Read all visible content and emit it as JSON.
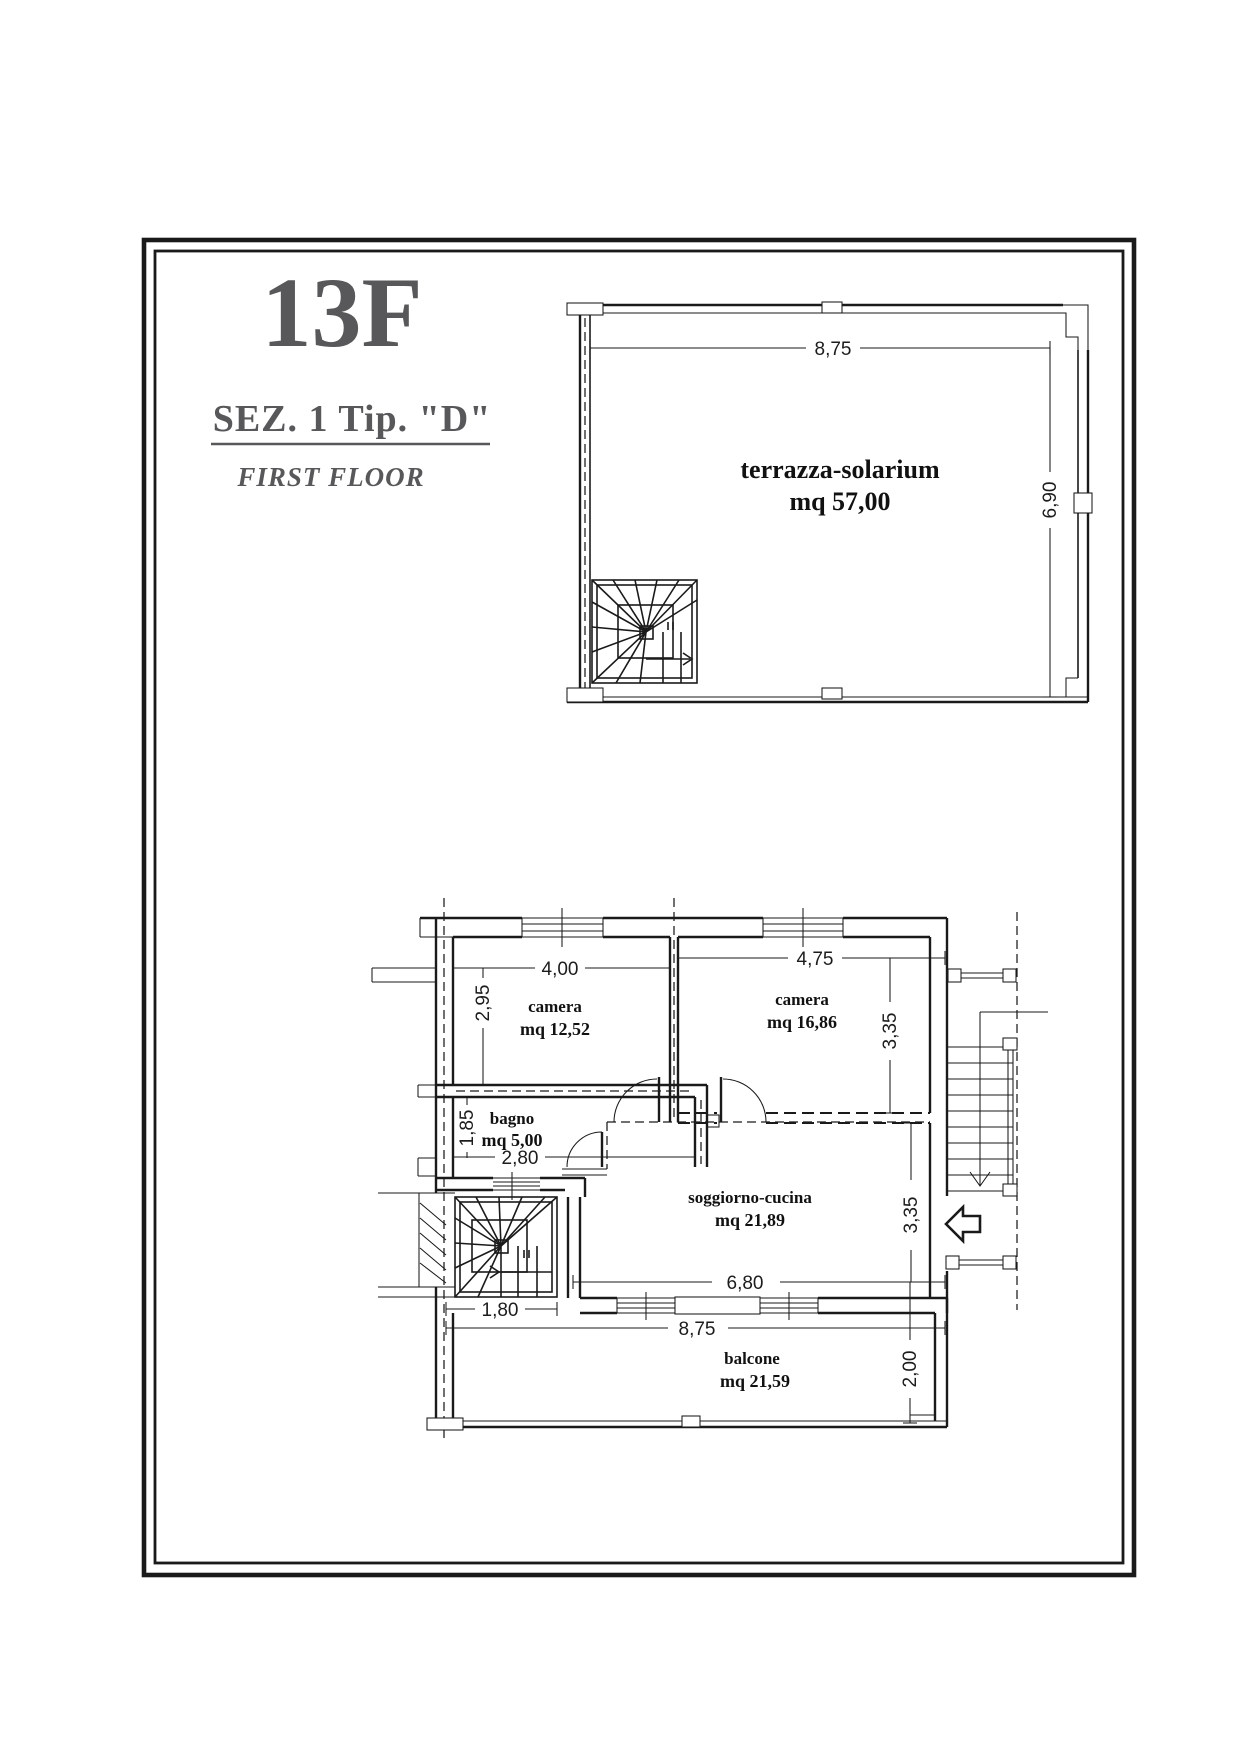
{
  "title_block": {
    "unit": "13F",
    "section": "SEZ. 1  Tip. \"D\"",
    "floor": "FIRST FLOOR"
  },
  "terrace": {
    "room": "terrazza-solarium",
    "area": "mq 57,00",
    "dim_width": "8,75",
    "dim_depth": "6,90"
  },
  "apartment": {
    "camera1": {
      "name": "camera",
      "area": "mq 12,52",
      "dim_width": "4,00",
      "dim_depth": "2,95"
    },
    "camera2": {
      "name": "camera",
      "area": "mq 16,86",
      "dim_width": "4,75",
      "dim_depth": "3,35"
    },
    "bagno": {
      "name": "bagno",
      "area": "mq 5,00",
      "dim_width": "2,80",
      "dim_depth": "1,85"
    },
    "soggiorno": {
      "name": "soggiorno-cucina",
      "area": "mq 21,89",
      "dim_width": "6,80",
      "dim_depth": "3,35"
    },
    "balcone": {
      "name": "balcone",
      "area": "mq 21,59",
      "dim_width": "8,75",
      "dim_depth": "2,00"
    },
    "stair": {
      "dim_width": "1,80"
    }
  },
  "colors": {
    "ink": "#1a1a1a",
    "title_gray": "#58585a",
    "stair_gray": "#6e6e6e"
  }
}
